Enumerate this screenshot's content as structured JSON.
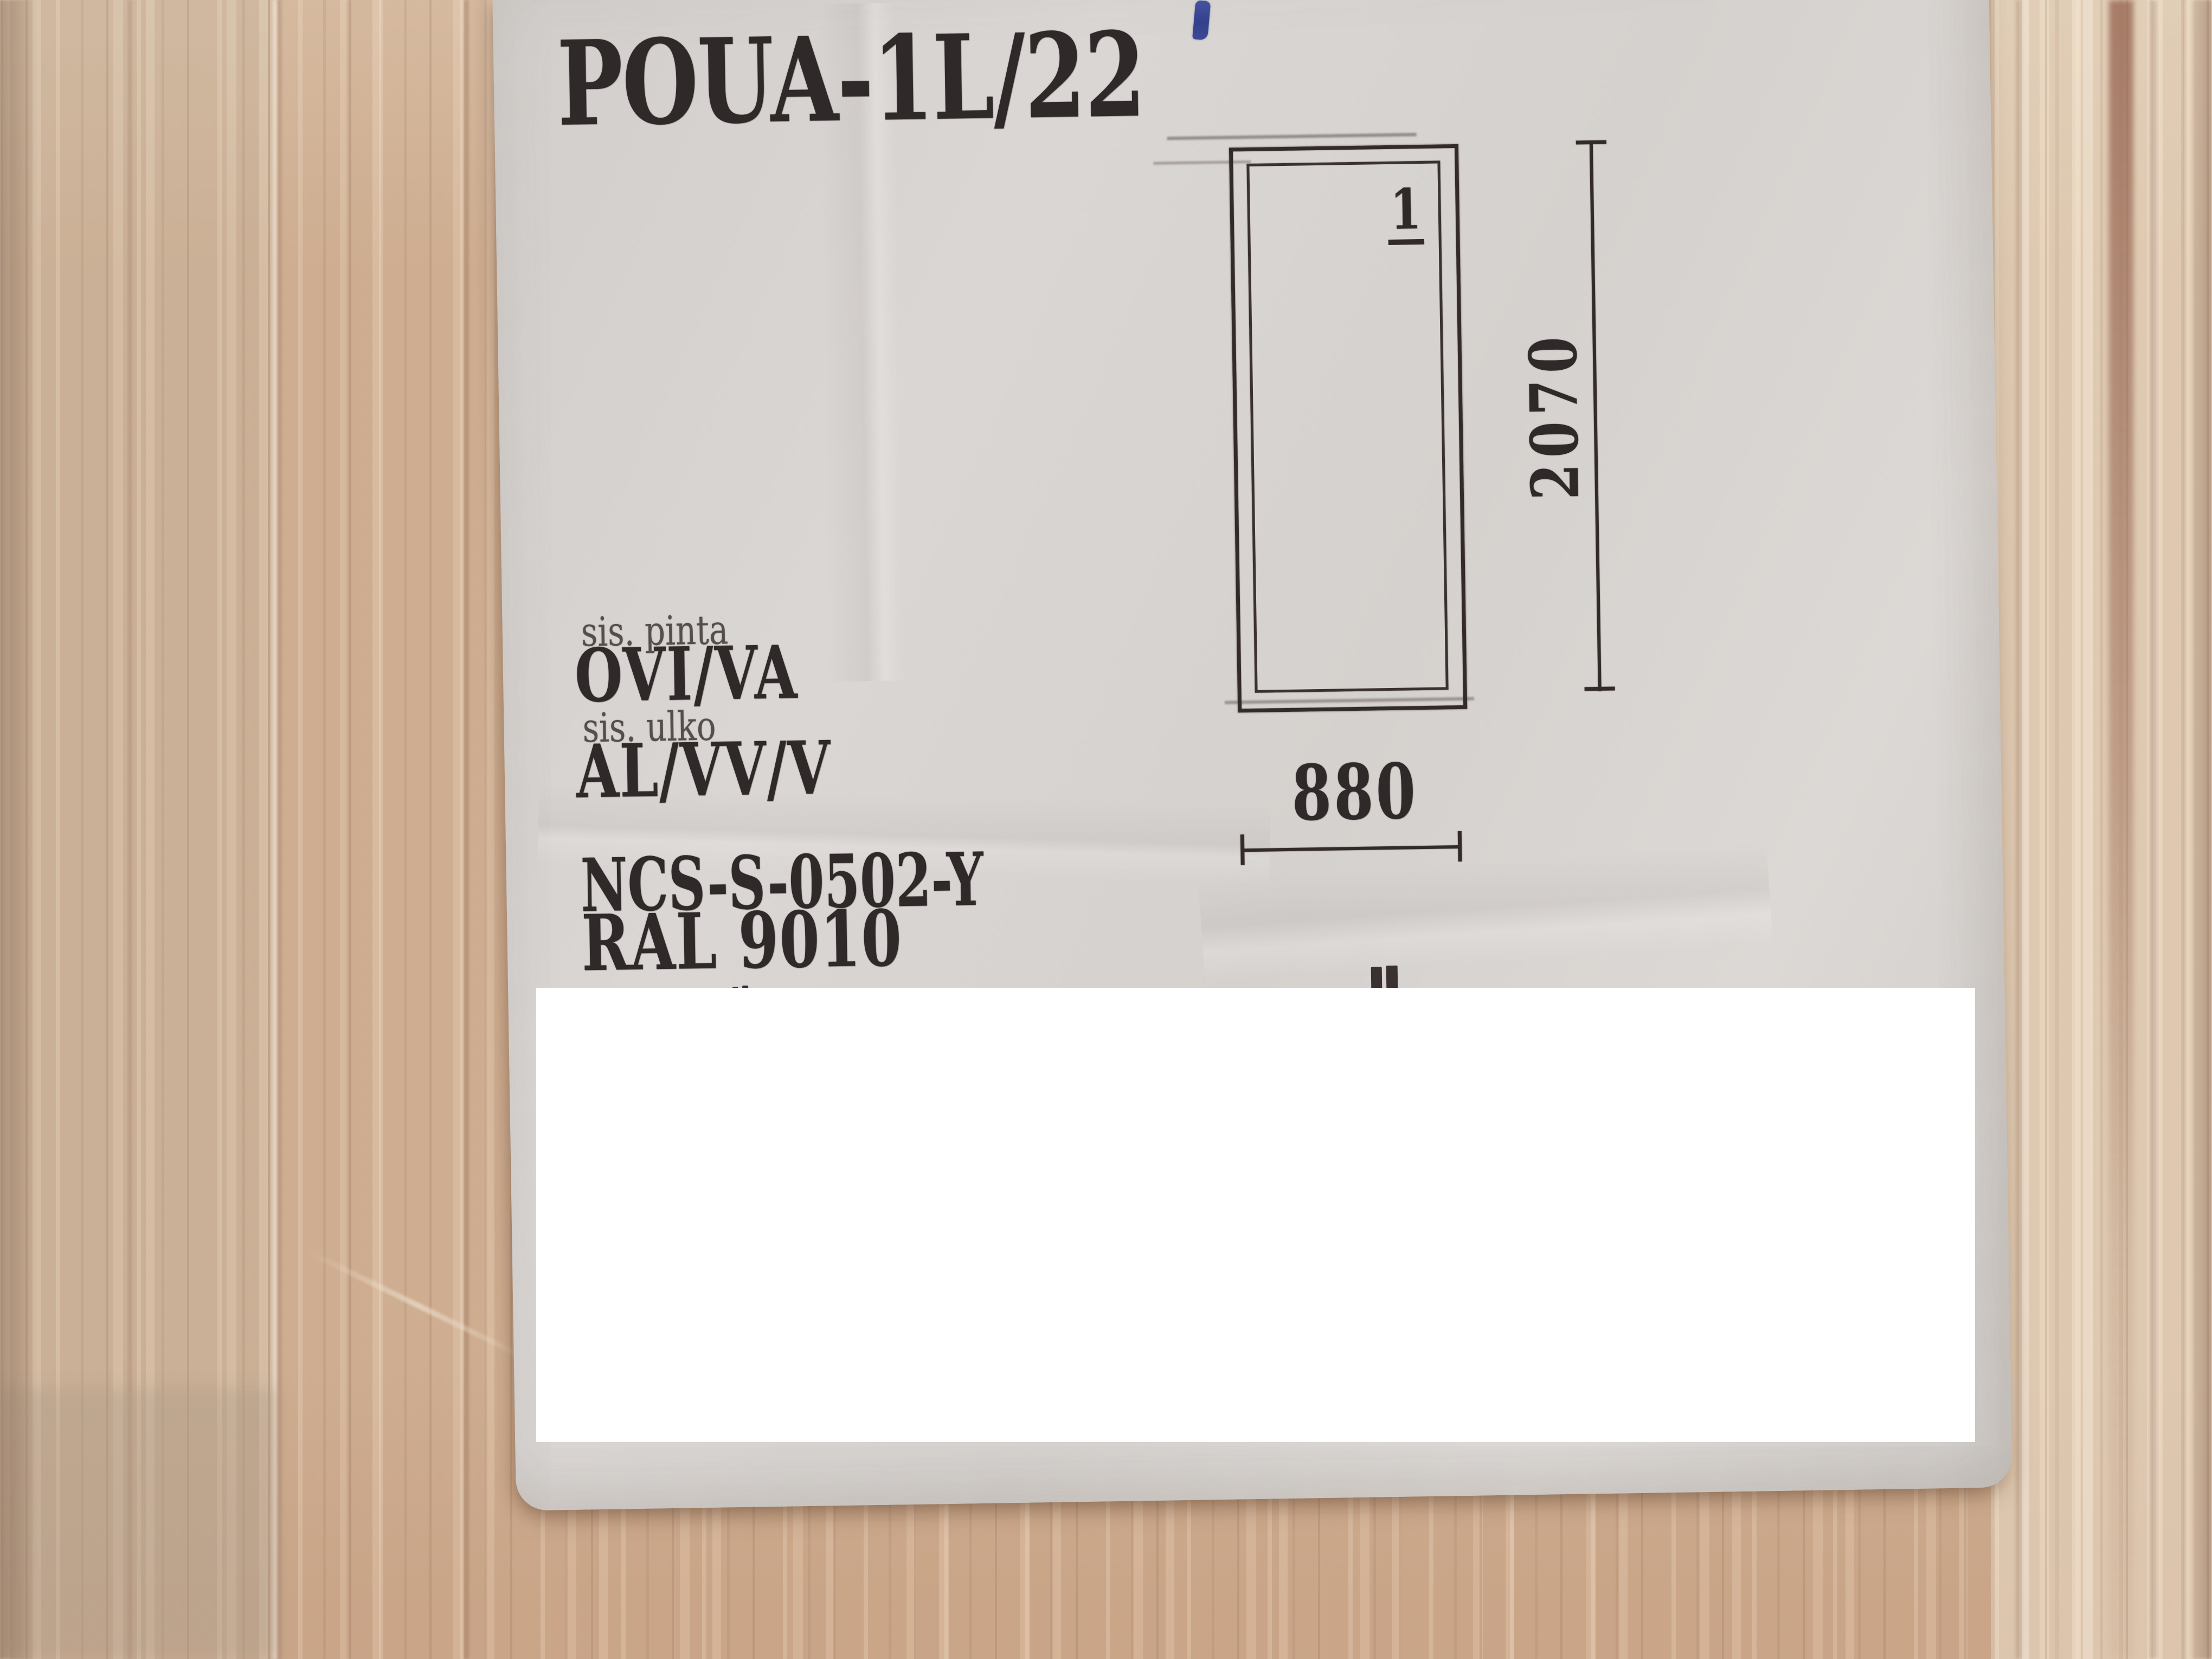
{
  "label": {
    "product_code": "POUA-1L/22",
    "surfaces": [
      {
        "label": "sis. pinta",
        "value": "OVI/VA"
      },
      {
        "label": "sis. ulko",
        "value": "AL/VV/V"
      }
    ],
    "color_codes": {
      "ncs": "NCS-S-0502-Y",
      "ral": "RAL 9010"
    },
    "diagram": {
      "panel_number": "1",
      "height_mm": "2070",
      "width_mm": "880"
    }
  },
  "colors": {
    "paper": "#d8d4d1",
    "ink": "#302929",
    "pen_mark_blue": "#3b4d9c",
    "redaction_white": "#ffffff",
    "wood_pink": "#d3b295",
    "wood_gray_band": "#c9b89e",
    "wood_cream_band": "#e6dac4",
    "wood_dark_streak": "#a8836e"
  }
}
